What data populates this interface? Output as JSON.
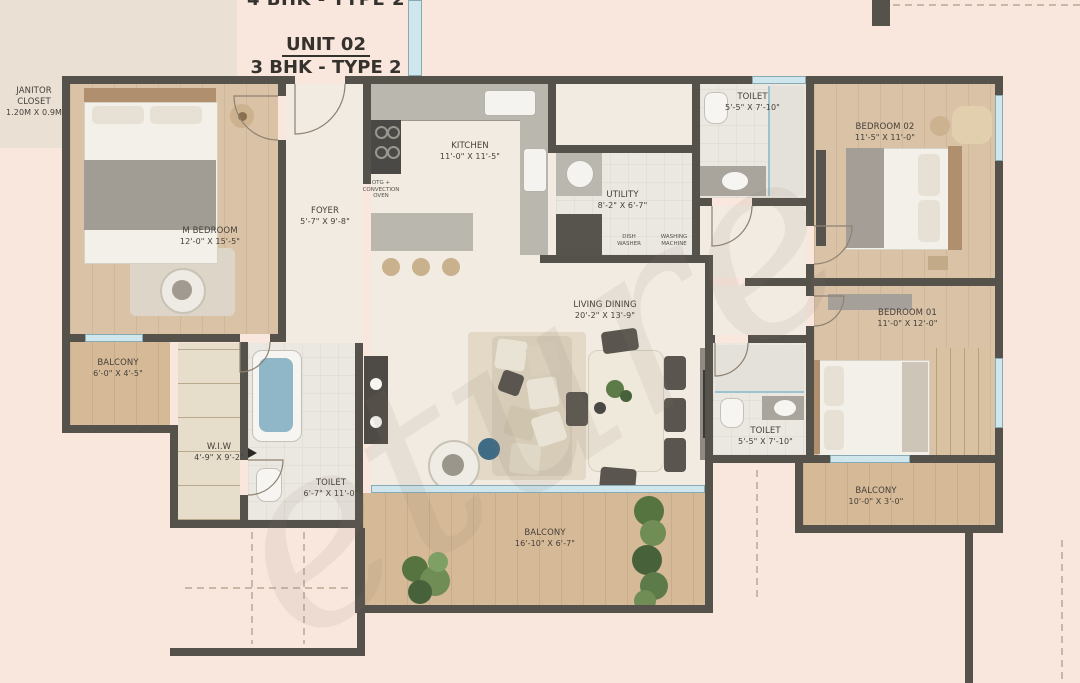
{
  "title": {
    "partial_top": "4 BHK - TYPE 2",
    "unit": "UNIT 02",
    "type": "3 BHK - TYPE 2"
  },
  "rooms": {
    "janitor": {
      "name": "JANITOR CLOSET",
      "dims": "1.20M X 0.9M"
    },
    "m_bedroom": {
      "name": "M BEDROOM",
      "dims": "12'-0\" X 15'-5\""
    },
    "foyer": {
      "name": "FOYER",
      "dims": "5'-7\" X 9'-8\""
    },
    "kitchen": {
      "name": "KITCHEN",
      "dims": "11'-0\" X 11'-5\""
    },
    "utility": {
      "name": "UTILITY",
      "dims": "8'-2\" X 6'-7\""
    },
    "toilet_top": {
      "name": "TOILET",
      "dims": "5'-5\" X 7'-10\""
    },
    "bedroom02": {
      "name": "BEDROOM 02",
      "dims": "11'-5\" X 11'-0\""
    },
    "bedroom01": {
      "name": "BEDROOM 01",
      "dims": "11'-0\" X 12'-0\""
    },
    "living": {
      "name": "LIVING DINING",
      "dims": "20'-2\" X 13'-9\""
    },
    "balcony_left": {
      "name": "BALCONY",
      "dims": "6'-0\" X 4'-5\""
    },
    "wiw": {
      "name": "W.I.W",
      "dims": "4'-9\" X 9'-2\""
    },
    "toilet_bottom": {
      "name": "TOILET",
      "dims": "6'-7\" X 11'-0\""
    },
    "balcony_bottom": {
      "name": "BALCONY",
      "dims": "16'-10\" X 6'-7\""
    },
    "toilet_right": {
      "name": "TOILET",
      "dims": "5'-5\" X 7'-10\""
    },
    "balcony_right": {
      "name": "BALCONY",
      "dims": "10'-0\" X 3'-0\""
    }
  },
  "appliances": {
    "oven": "OTG + CONVECTION OVEN",
    "dish_washer": "DISH WASHER",
    "washing_machine": "WASHING MACHINE"
  },
  "watermark": {
    "text": "eture"
  },
  "colors": {
    "background": "#f9e7de",
    "wall": "#55524b",
    "glass": "#cfe6ec",
    "wood_floor": "#d9c2a5",
    "interior_floor": "#f1ebe1",
    "plant_green": "#5d7b49",
    "accent_blue": "#3f6b85"
  }
}
